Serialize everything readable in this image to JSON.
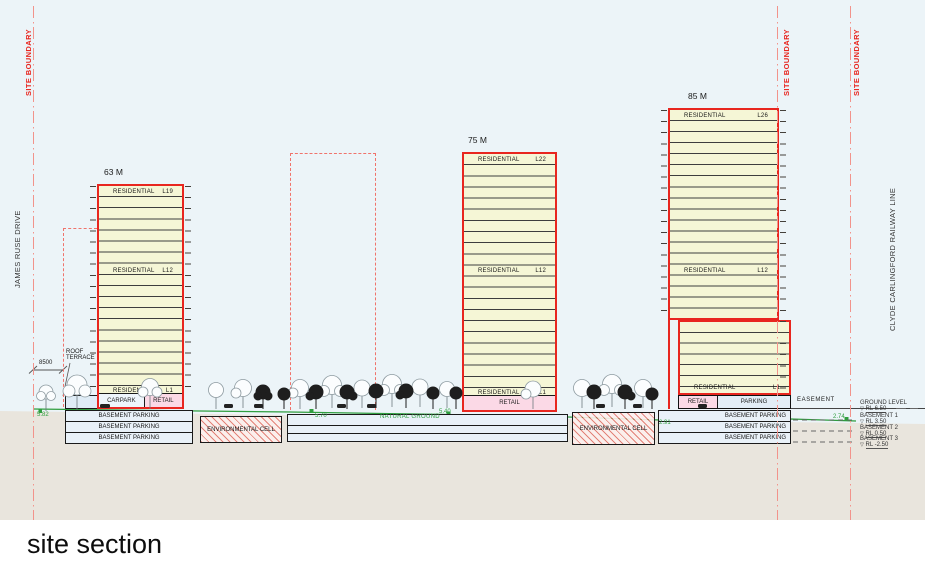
{
  "title": "site section",
  "site_boundary_label": "SITE BOUNDARY",
  "left_road": "JAMES RUSE DRIVE",
  "right_rail": "CLYDE CARLINGFORD RAILWAY LINE",
  "easement": "EASEMENT",
  "roof_terrace": "ROOF TERRACE",
  "dim_8500": "8500",
  "residential": "RESIDENTIAL",
  "level_symbol": "▽",
  "towers": [
    {
      "height": "63 M",
      "top": "L19",
      "mid": "L12",
      "low": "L1",
      "pod1": "CARPARK",
      "pod2": "RETAIL"
    },
    {
      "height": "75 M",
      "top": "L22",
      "mid": "L12",
      "low": "L1",
      "pod1": "RETAIL"
    },
    {
      "height": "85 M",
      "top": "L26",
      "mid": "L12",
      "low": "L1",
      "pod1": "RETAIL",
      "pod2": "PARKING"
    }
  ],
  "basement_parking": "BASEMENT PARKING",
  "environmental_cell": "ENVIRONMENTAL CELL",
  "natural_ground": "NATURAL GROUND",
  "spot_levels": {
    "a": "5.82",
    "b": "5.70",
    "c": "5.40",
    "d": "2.91",
    "e": "2.74"
  },
  "levels": [
    {
      "name": "GROUND LEVEL",
      "rl": "RL 6.50"
    },
    {
      "name": "BASEMENT 1",
      "rl": "RL 3.50"
    },
    {
      "name": "BASEMENT 2",
      "rl": "RL 0.50"
    },
    {
      "name": "BASEMENT 3",
      "rl": "RL -2.50"
    }
  ],
  "colors": {
    "red": "#e8261f",
    "boundary_pink": "#f2938b",
    "green": "#2f9e3f",
    "tower_fill": "#f5f6d6",
    "retail_pink": "#fbd9e6",
    "parking_blue": "#e3edf6",
    "earth": "#e9e5dd",
    "sky": "#ecf4f8"
  }
}
